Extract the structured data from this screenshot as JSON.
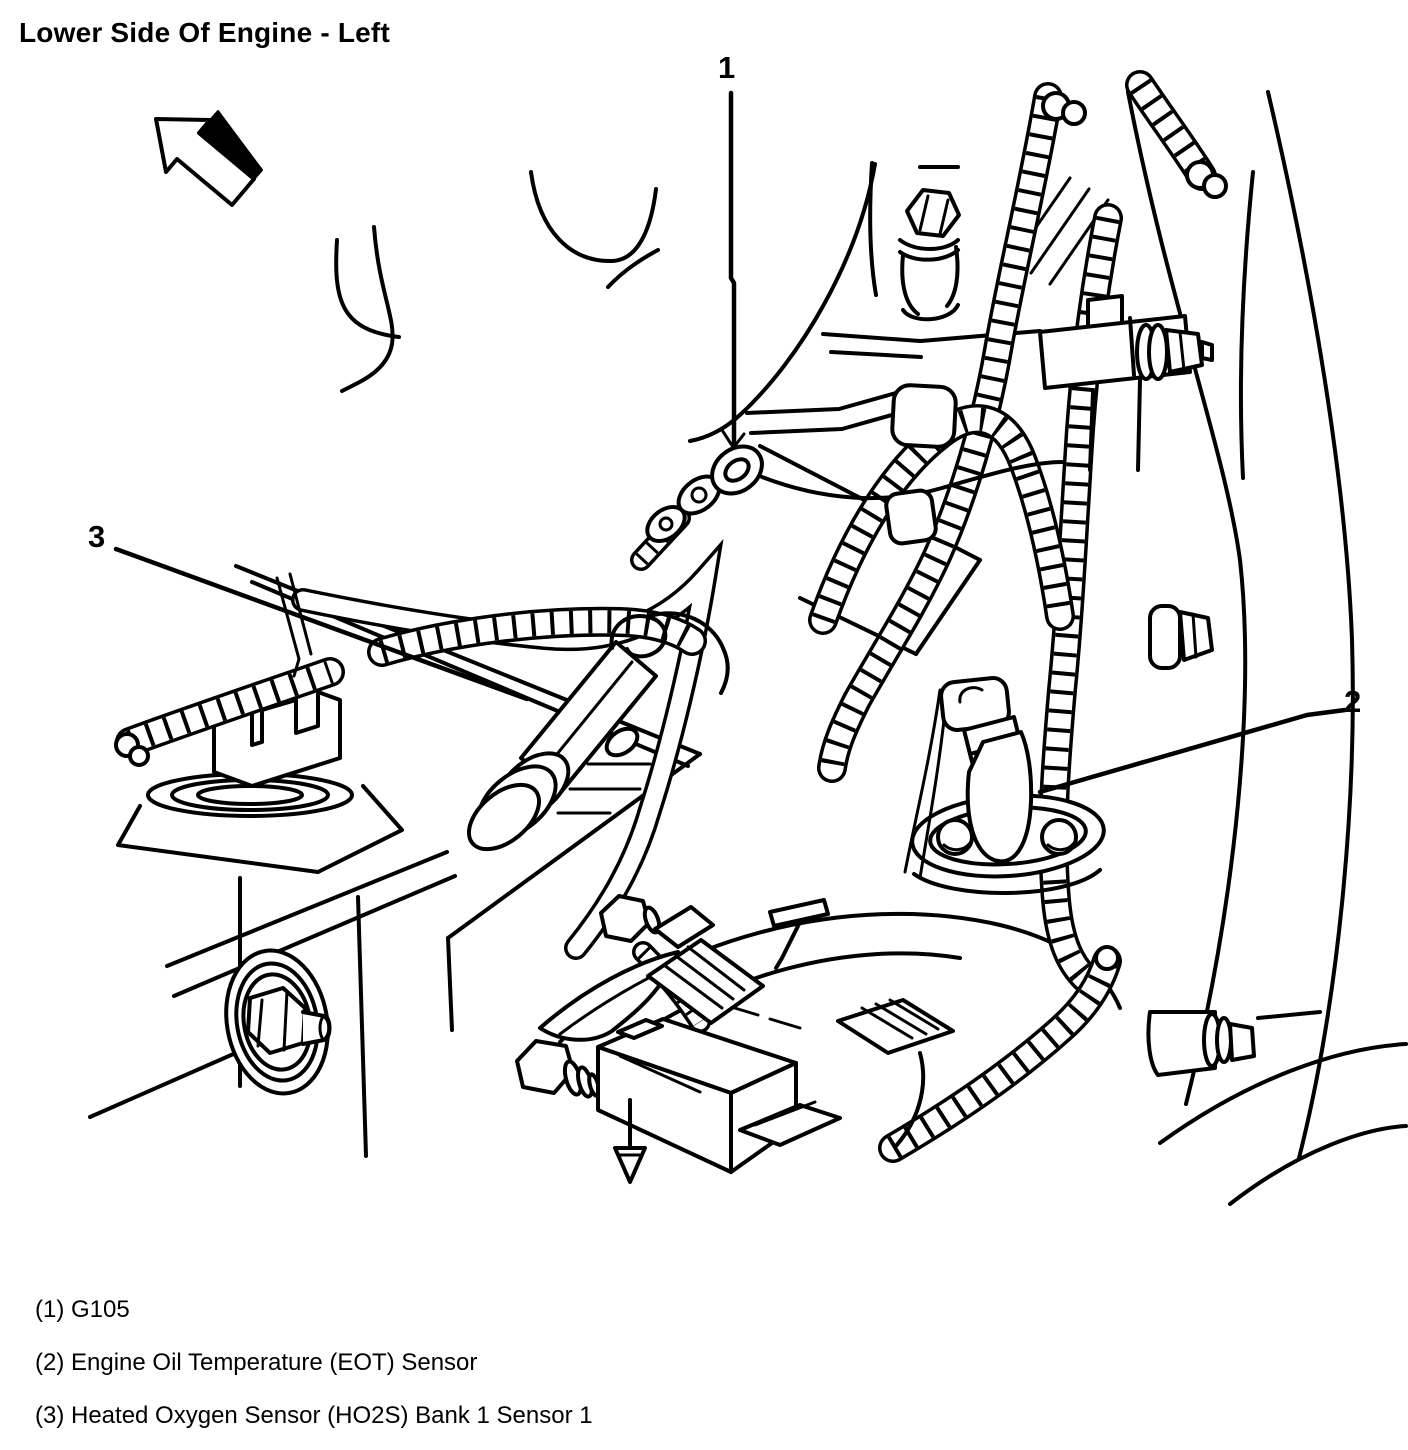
{
  "title": "Lower Side Of Engine - Left",
  "icons": {
    "orientation_arrow": "arrow-up-left"
  },
  "callouts": [
    {
      "number": "1"
    },
    {
      "number": "2"
    },
    {
      "number": "3"
    }
  ],
  "legend": {
    "items": [
      {
        "text": "(1) G105"
      },
      {
        "text": "(2) Engine Oil Temperature (EOT) Sensor"
      },
      {
        "text": "(3) Heated Oxygen Sensor (HO2S) Bank 1 Sensor 1"
      }
    ]
  }
}
